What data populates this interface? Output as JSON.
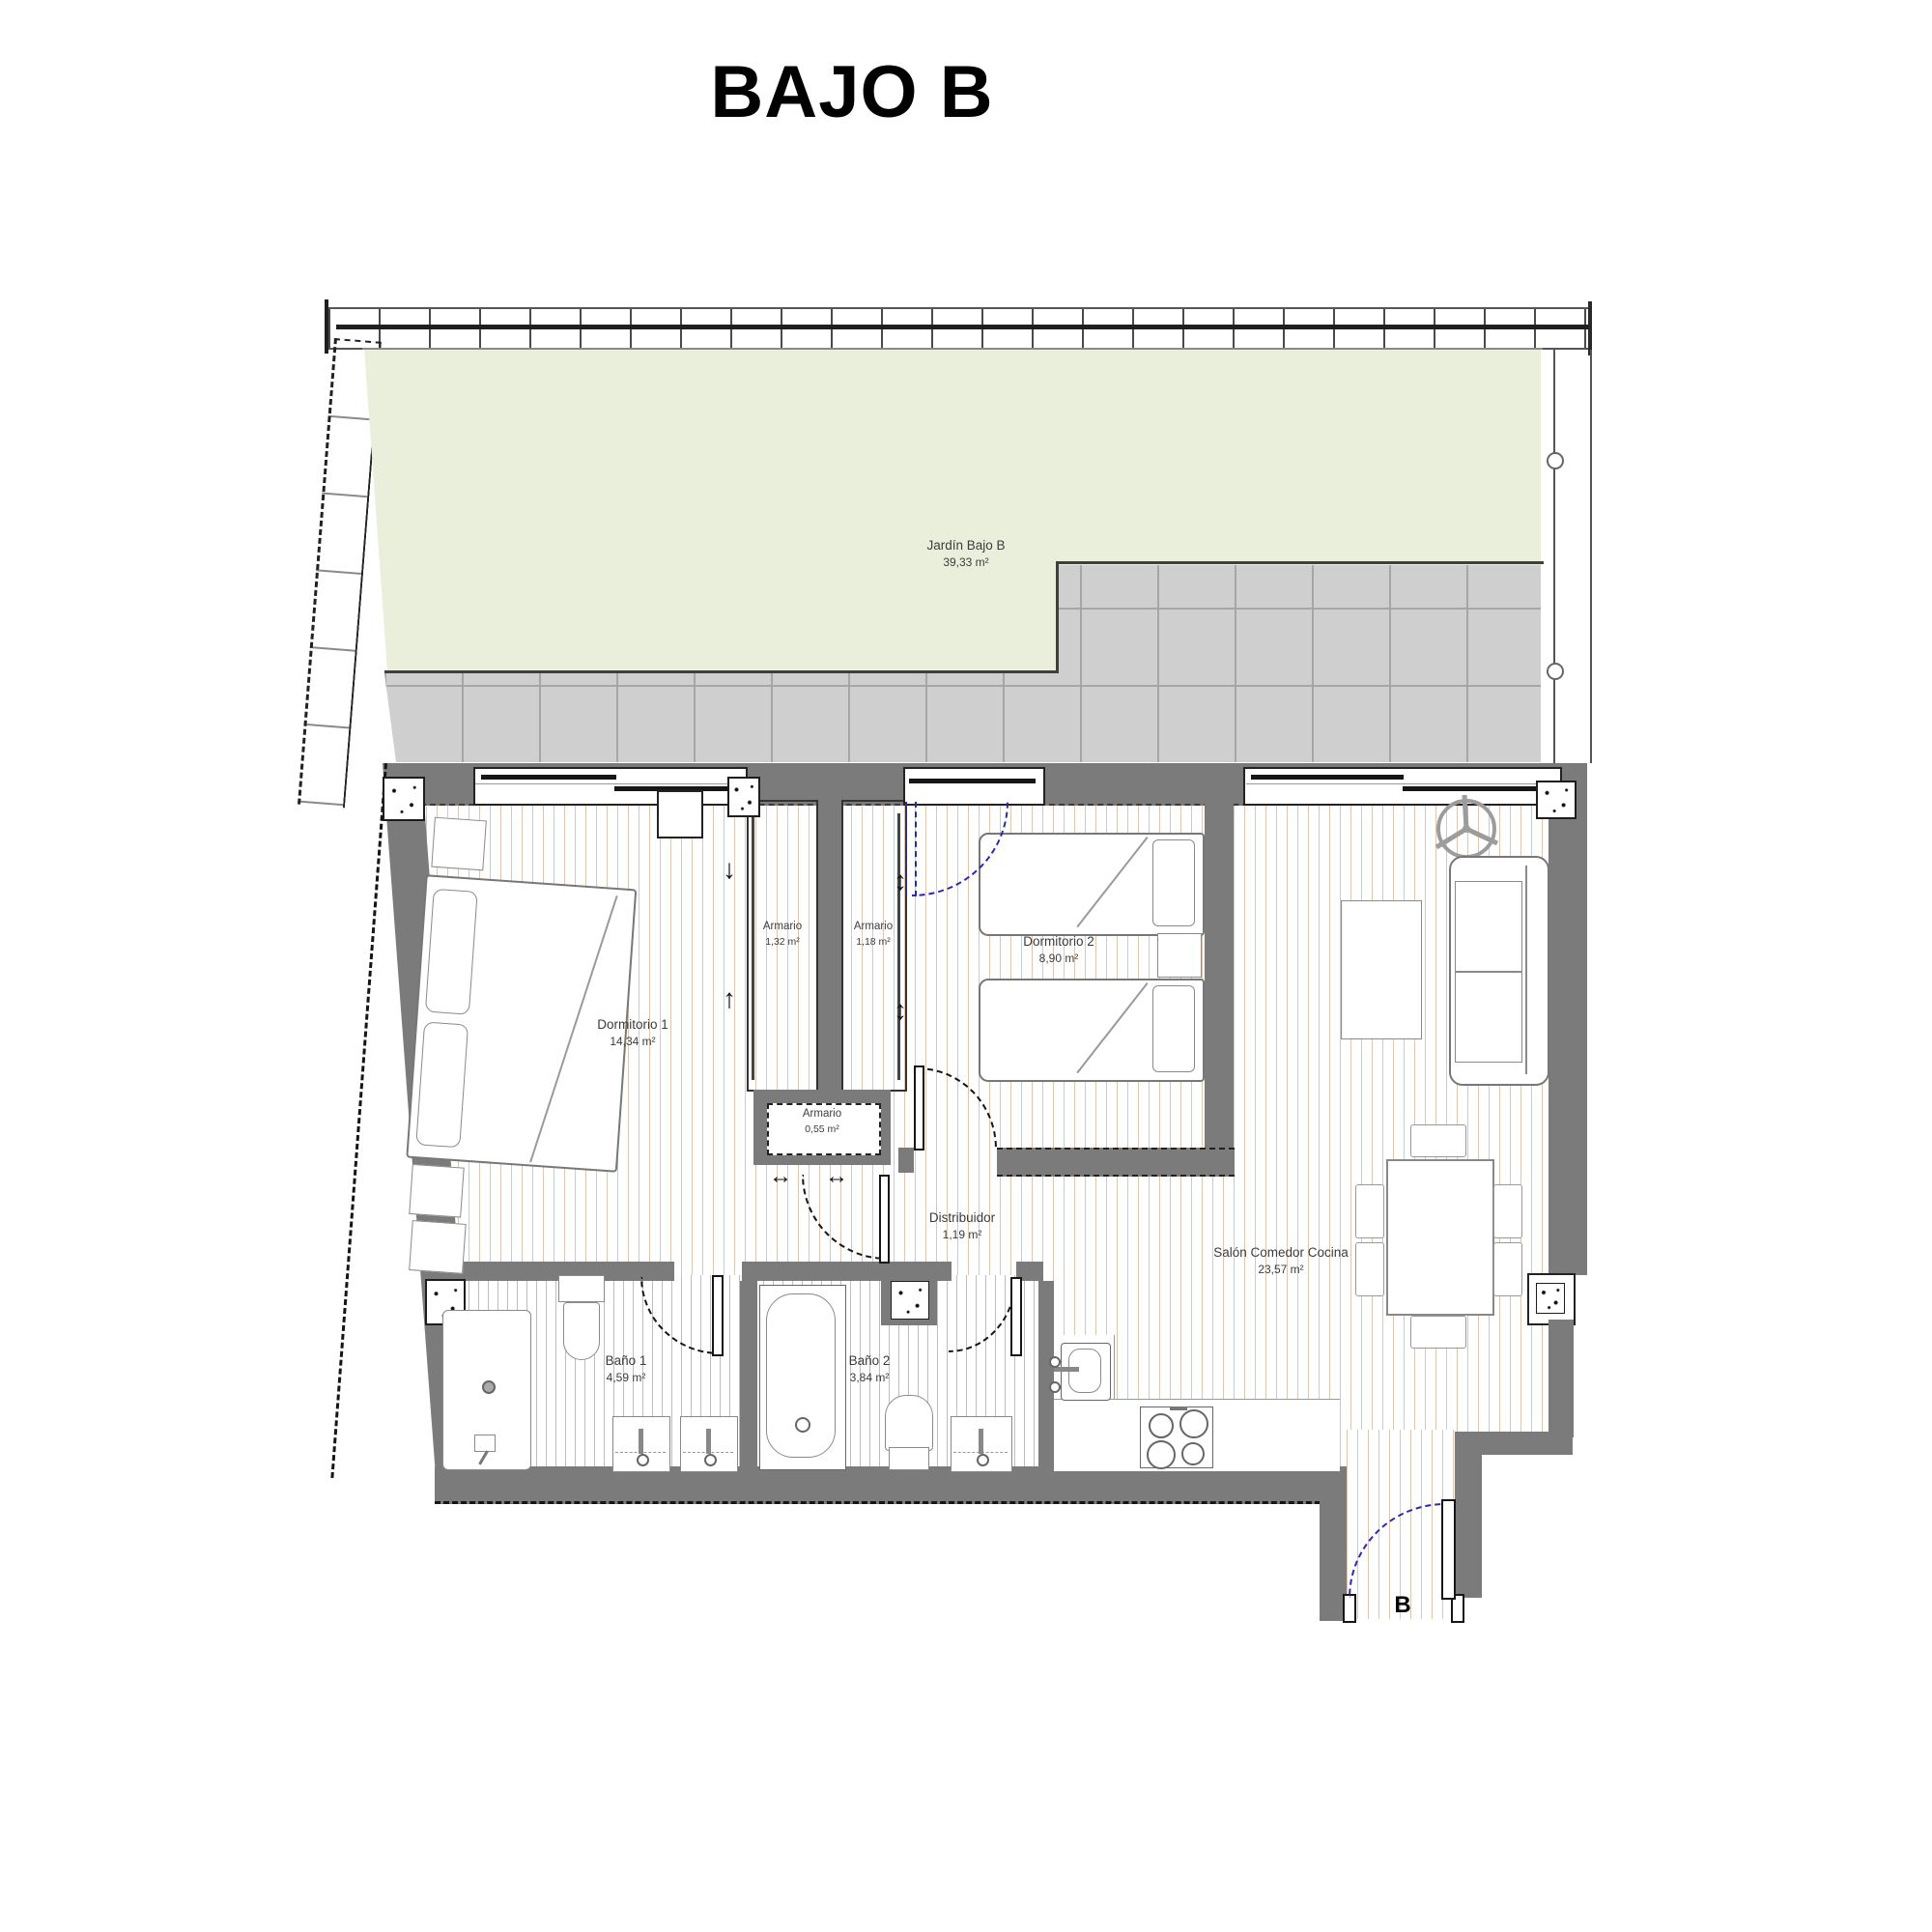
{
  "title": "BAJO B",
  "entrance": {
    "label": "B"
  },
  "rooms": {
    "jardin": {
      "name": "Jardín Bajo B",
      "area": "39,33 m²"
    },
    "dormitorio1": {
      "name": "Dormitorio 1",
      "area": "14,34 m²"
    },
    "armario1": {
      "name": "Armario",
      "area": "1,32 m²"
    },
    "armario2": {
      "name": "Armario",
      "area": "1,18 m²"
    },
    "armario3": {
      "name": "Armario",
      "area": "0,55 m²"
    },
    "dormitorio2": {
      "name": "Dormitorio 2",
      "area": "8,90 m²"
    },
    "distribuidor": {
      "name": "Distribuidor",
      "area": "1,19 m²"
    },
    "salon": {
      "name": "Salón Comedor Cocina",
      "area": "23,57 m²"
    },
    "bano1": {
      "name": "Baño 1",
      "area": "4,59 m²"
    },
    "bano2": {
      "name": "Baño 2",
      "area": "3,84 m²"
    }
  },
  "colors": {
    "wall": "#7b7b7b",
    "garden": "#e9efdb",
    "tiles": "#cfcfcf",
    "door_arc_blue": "#2a2aad",
    "hatch_warm": "#c69870",
    "hatch_cool": "#7d7d7d"
  }
}
